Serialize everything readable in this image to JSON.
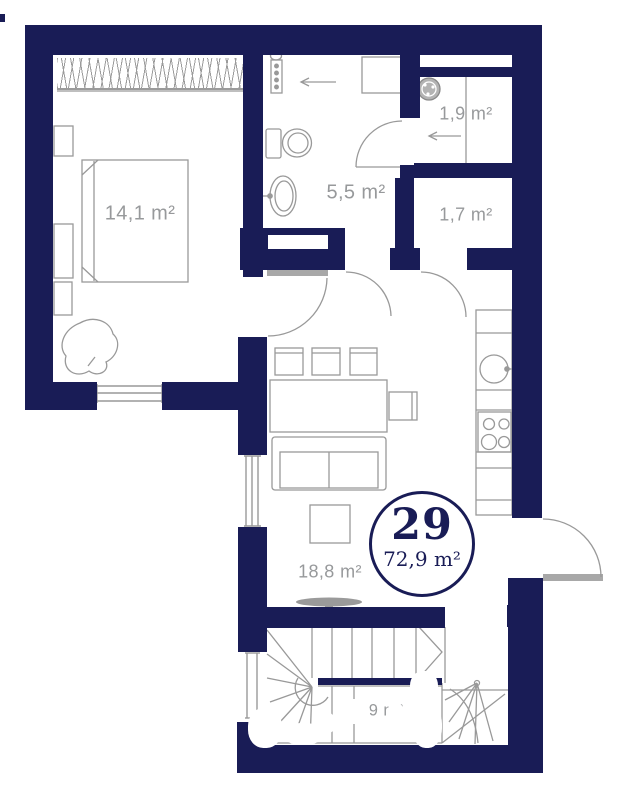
{
  "floor_plan": {
    "unit": {
      "number": "29",
      "total_area": "72,9 m²"
    },
    "rooms": [
      {
        "key": "bedroom",
        "area": "14,1 m²"
      },
      {
        "key": "bathroom",
        "area": "5,5 m²"
      },
      {
        "key": "storage",
        "area": "1,9 m²"
      },
      {
        "key": "wc",
        "area": "1,7 m²"
      },
      {
        "key": "living-kitchen",
        "area": "18,8 m²"
      },
      {
        "key": "stair-hall",
        "area": "10,9 m²"
      }
    ],
    "colors": {
      "wall": "#191c56",
      "line": "#999999",
      "label": "#97999b",
      "leaf": "#a8a8a8"
    }
  }
}
